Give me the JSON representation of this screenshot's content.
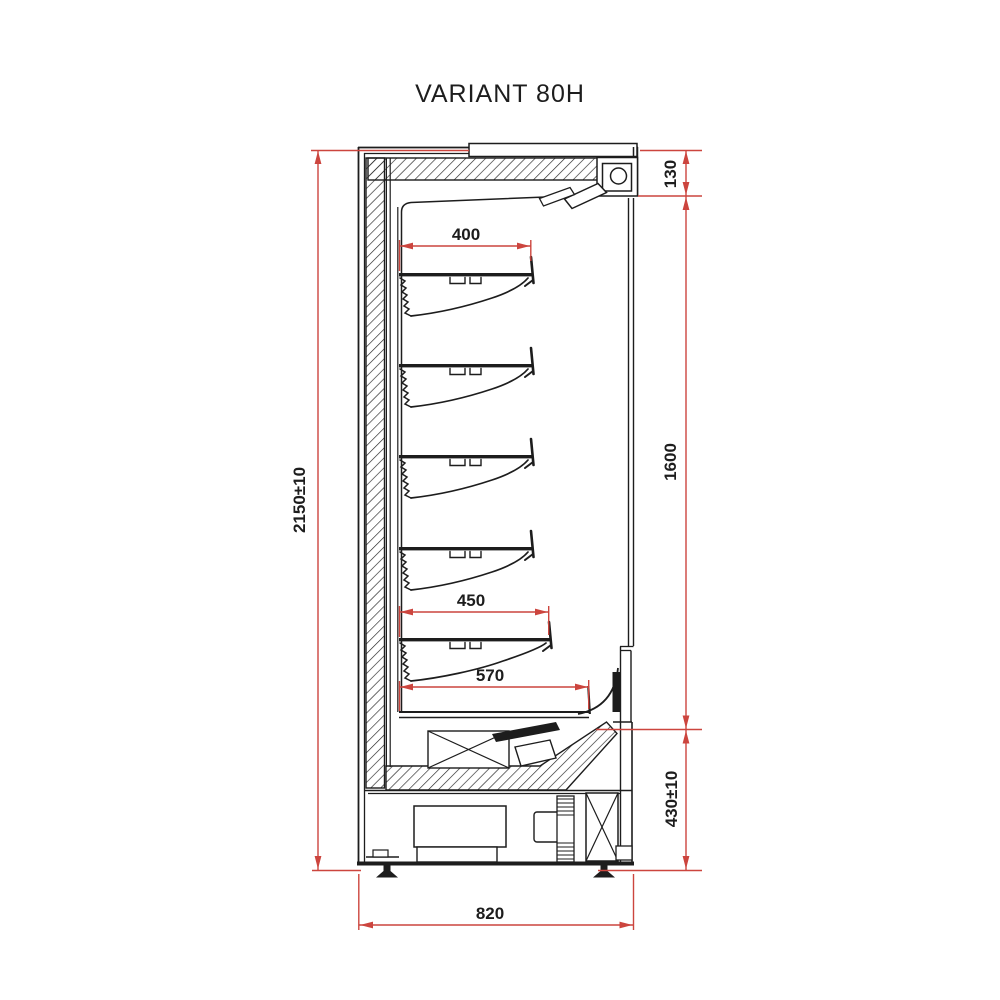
{
  "title": "VARIANT 80H",
  "dims": {
    "overall_height": "2150±10",
    "canopy_height": "130",
    "opening_height": "1600",
    "base_height": "430±10",
    "overall_depth": "820",
    "upper_shelf_depth": "400",
    "lower_shelf_depth": "450",
    "base_shelf_depth": "570"
  },
  "colors": {
    "dimension_red": "#cc453e",
    "line_black": "#1d1d1d",
    "background": "#ffffff"
  }
}
